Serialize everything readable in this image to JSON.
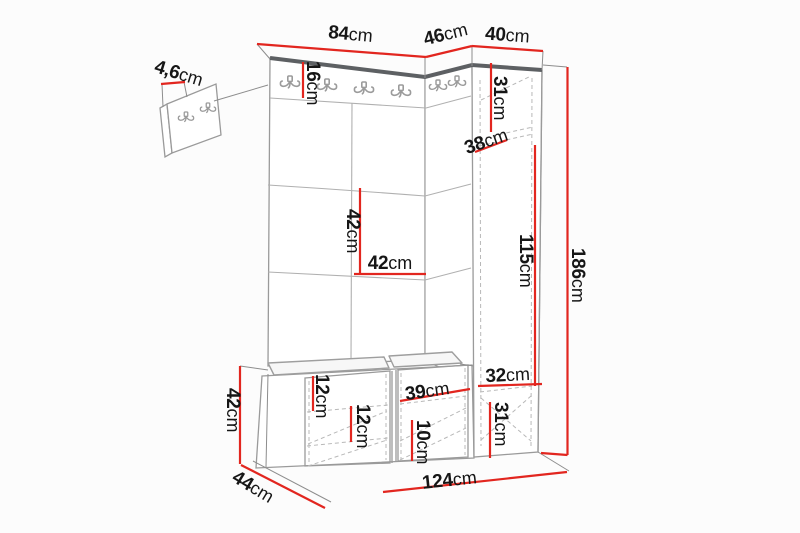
{
  "diagram": {
    "type": "furniture-dimension-drawing",
    "subject": "hallway wardrobe unit with coat hooks, upholstered panels, bench and tall cabinet",
    "colors": {
      "dimension": "#e2261f",
      "text": "#161616",
      "outline": "#9a9a9a",
      "dark_edge": "#5d6063",
      "background": "#fcfcfc"
    },
    "dims": {
      "panel_width": {
        "num": "84",
        "unit": "cm"
      },
      "cabinet_depth": {
        "num": "46",
        "unit": "cm"
      },
      "cabinet_width": {
        "num": "40",
        "unit": "cm"
      },
      "wall_panel_thickness": {
        "num": "4,6",
        "unit": "cm"
      },
      "hook_rail_height": {
        "num": "16",
        "unit": "cm"
      },
      "cabinet_top_compartment": {
        "num": "31",
        "unit": "cm"
      },
      "cabinet_shelf_depth": {
        "num": "38",
        "unit": "cm"
      },
      "cabinet_hanging_height": {
        "num": "115",
        "unit": "cm"
      },
      "total_height": {
        "num": "186",
        "unit": "cm"
      },
      "panel_tile_height": {
        "num": "42",
        "unit": "cm"
      },
      "panel_tile_width": {
        "num": "42",
        "unit": "cm"
      },
      "bench_height": {
        "num": "42",
        "unit": "cm"
      },
      "bench_depth": {
        "num": "44",
        "unit": "cm"
      },
      "total_width": {
        "num": "124",
        "unit": "cm"
      },
      "bench_shelf_gap_upper": {
        "num": "12",
        "unit": "cm"
      },
      "bench_shelf_gap_lower": {
        "num": "12",
        "unit": "cm"
      },
      "bench_compartment_width": {
        "num": "39",
        "unit": "cm"
      },
      "bench_compartment_height": {
        "num": "10",
        "unit": "cm"
      },
      "cabinet_inner_width": {
        "num": "32",
        "unit": "cm"
      },
      "cabinet_bottom_compartment": {
        "num": "31",
        "unit": "cm"
      }
    }
  }
}
